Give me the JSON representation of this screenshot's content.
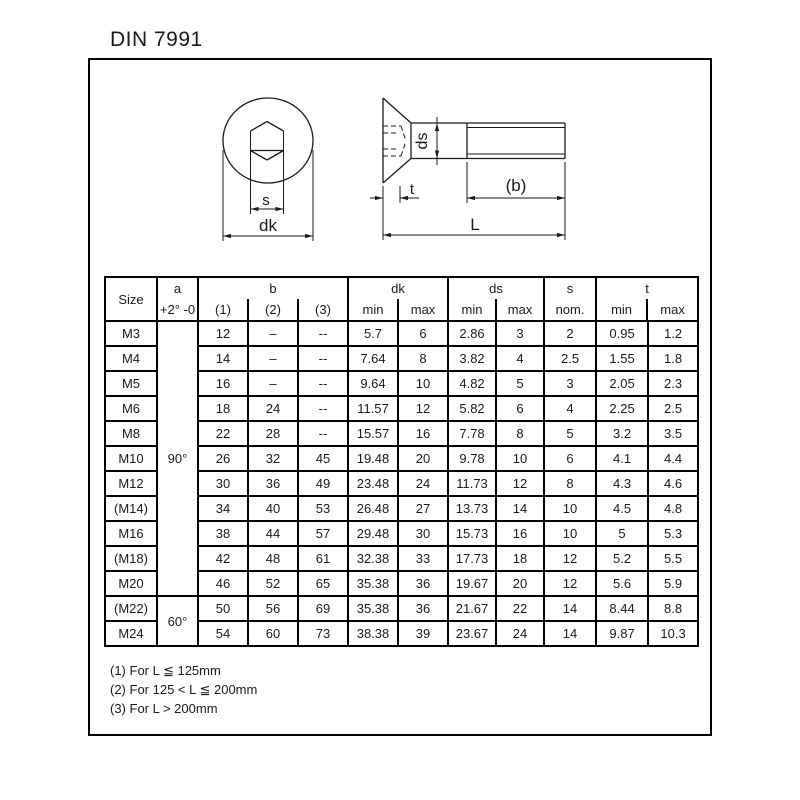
{
  "title": "DIN 7991",
  "colors": {
    "ink": "#1a1a1a",
    "line": "#000000",
    "background": "#ffffff"
  },
  "drawing": {
    "labels": {
      "s": "s",
      "dk": "dk",
      "ds": "ds",
      "t": "t",
      "b": "(b)",
      "L": "L"
    }
  },
  "table": {
    "header": {
      "size": "Size",
      "a": "a",
      "a_sub": "+2° -0",
      "b": "b",
      "b_subs": [
        "(1)",
        "(2)",
        "(3)"
      ],
      "dk": "dk",
      "ds": "ds",
      "s": "s",
      "s_sub": "nom.",
      "t": "t",
      "min": "min",
      "max": "max"
    },
    "a_values": {
      "deg90": "90°",
      "deg60": "60°"
    },
    "a_span_90": 11,
    "a_span_60": 2,
    "rows": [
      [
        "M3",
        "12",
        "–",
        "--",
        "5.7",
        "6",
        "2.86",
        "3",
        "2",
        "0.95",
        "1.2"
      ],
      [
        "M4",
        "14",
        "–",
        "--",
        "7.64",
        "8",
        "3.82",
        "4",
        "2.5",
        "1.55",
        "1.8"
      ],
      [
        "M5",
        "16",
        "–",
        "--",
        "9.64",
        "10",
        "4.82",
        "5",
        "3",
        "2.05",
        "2.3"
      ],
      [
        "M6",
        "18",
        "24",
        "--",
        "11.57",
        "12",
        "5.82",
        "6",
        "4",
        "2.25",
        "2.5"
      ],
      [
        "M8",
        "22",
        "28",
        "--",
        "15.57",
        "16",
        "7.78",
        "8",
        "5",
        "3.2",
        "3.5"
      ],
      [
        "M10",
        "26",
        "32",
        "45",
        "19.48",
        "20",
        "9.78",
        "10",
        "6",
        "4.1",
        "4.4"
      ],
      [
        "M12",
        "30",
        "36",
        "49",
        "23.48",
        "24",
        "11.73",
        "12",
        "8",
        "4.3",
        "4.6"
      ],
      [
        "(M14)",
        "34",
        "40",
        "53",
        "26.48",
        "27",
        "13.73",
        "14",
        "10",
        "4.5",
        "4.8"
      ],
      [
        "M16",
        "38",
        "44",
        "57",
        "29.48",
        "30",
        "15.73",
        "16",
        "10",
        "5",
        "5.3"
      ],
      [
        "(M18)",
        "42",
        "48",
        "61",
        "32.38",
        "33",
        "17.73",
        "18",
        "12",
        "5.2",
        "5.5"
      ],
      [
        "M20",
        "46",
        "52",
        "65",
        "35.38",
        "36",
        "19.67",
        "20",
        "12",
        "5.6",
        "5.9"
      ],
      [
        "(M22)",
        "50",
        "56",
        "69",
        "35.38",
        "36",
        "21.67",
        "22",
        "14",
        "8.44",
        "8.8"
      ],
      [
        "M24",
        "54",
        "60",
        "73",
        "38.38",
        "39",
        "23.67",
        "24",
        "14",
        "9.87",
        "10.3"
      ]
    ]
  },
  "footnotes": [
    "(1) For L ≦ 125mm",
    "(2) For 125 < L ≦ 200mm",
    "(3) For L > 200mm"
  ]
}
